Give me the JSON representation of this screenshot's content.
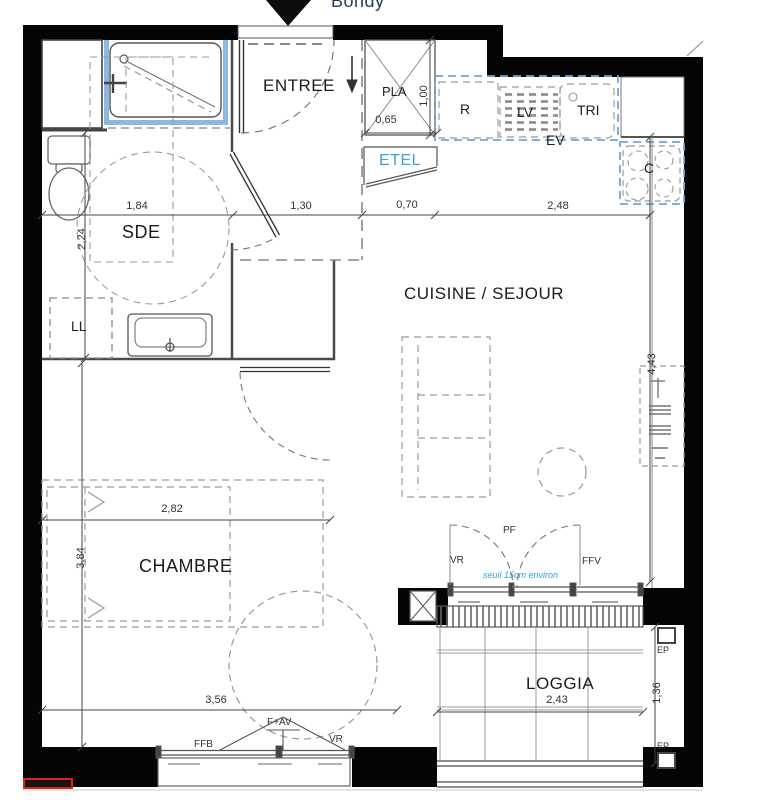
{
  "marker": {
    "city": "Bondy"
  },
  "rooms": {
    "entree": "ENTREE",
    "sde": "SDE",
    "cuisine_sejour": "CUISINE / SEJOUR",
    "chambre": "CHAMBRE",
    "loggia": "LOGGIA"
  },
  "fixtures": {
    "closet": "PLA",
    "etel": "ETEL",
    "fridge": "R",
    "dishwasher": "LV",
    "waste_sorting": "TRI",
    "sink": "EV",
    "cooktop": "C",
    "washing_machine": "LL"
  },
  "openings": {
    "loggia_door": "PF",
    "loggia_shutter": "VR",
    "loggia_fixed_window": "FFV",
    "threshold_note": "seuil 15cm environ",
    "rain_pipe_top": "EP",
    "rain_pipe_bottom": "EP",
    "chambre_window_fixed": "FFB",
    "chambre_window": "F+AV",
    "chambre_shutter": "VR"
  },
  "dimensions": {
    "sde_width": "1,84",
    "entree_width": "1,30",
    "passage_width": "0,70",
    "kitchen_width": "2,48",
    "sde_depth": "2,24",
    "closet_depth": "1,00",
    "closet_width": "0,65",
    "sejour_depth": "4,43",
    "chambre_width": "2,82",
    "chambre_depth": "3,84",
    "chambre_window_span": "3,56",
    "loggia_width": "2,43",
    "loggia_depth": "1,36"
  },
  "colors": {
    "wall": "#050505",
    "counter_blue": "#6fa8dc",
    "shower_blue": "#8ab9e4",
    "etel_blue": "#41a0dc",
    "note_blue": "#2da3dd",
    "red_marker": "#e0221f"
  }
}
